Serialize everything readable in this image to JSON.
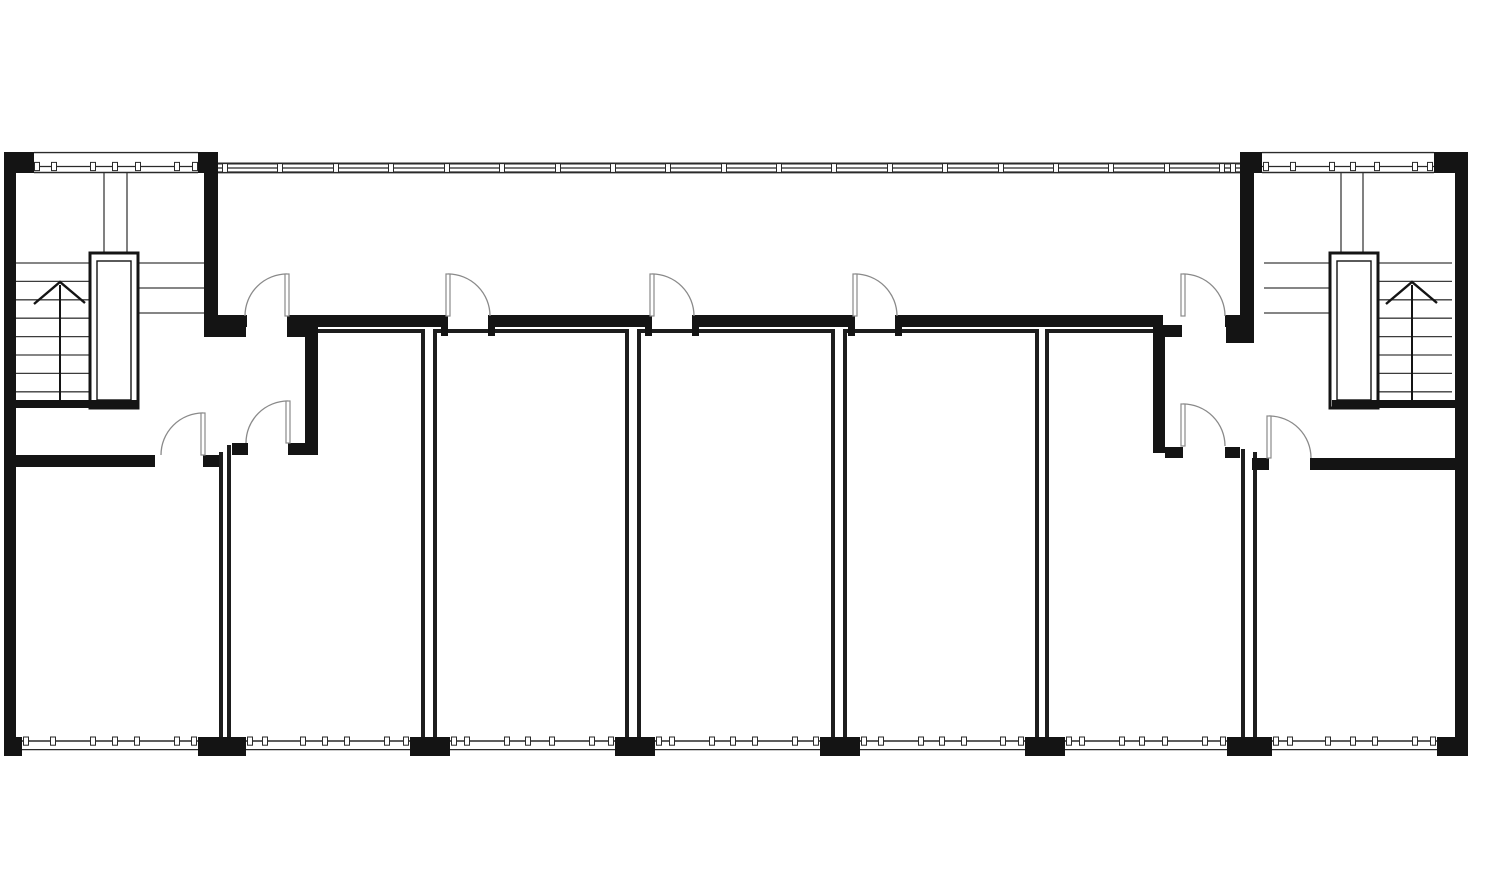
{
  "meta": {
    "kind": "architectural-floor-plan",
    "canvas": {
      "width": 1500,
      "height": 884
    }
  },
  "colors": {
    "background": "#ffffff",
    "wall": "#141414",
    "thin_wall": "#1d1d1d",
    "stair_line": "#3c3c3c",
    "door": "#8a8a8a",
    "band_line": "#2a2a2a",
    "tick_fill": "#ffffff"
  },
  "plan": {
    "solid_walls": [
      {
        "name": "exterior-wall-left",
        "r": [
          4,
          152,
          12,
          603
        ]
      },
      {
        "name": "exterior-wall-right",
        "r": [
          1455,
          152,
          13,
          603
        ]
      },
      {
        "name": "top-wall-left-block-west",
        "r": [
          4,
          152,
          30,
          21
        ]
      },
      {
        "name": "top-wall-left-block-east",
        "r": [
          198,
          152,
          20,
          21
        ]
      },
      {
        "name": "top-wall-right-block-west",
        "r": [
          1240,
          152,
          22,
          21
        ]
      },
      {
        "name": "top-wall-right-block-east",
        "r": [
          1434,
          152,
          34,
          21
        ]
      },
      {
        "name": "stair-separation-wall-left",
        "r": [
          204,
          152,
          14,
          185
        ]
      },
      {
        "name": "stair-separation-wall-right",
        "r": [
          1240,
          152,
          14,
          191
        ]
      },
      {
        "name": "corridor-wall-segment",
        "r": [
          218,
          315,
          29,
          12
        ]
      },
      {
        "name": "corridor-wall-segment",
        "r": [
          287,
          315,
          161,
          12
        ]
      },
      {
        "name": "corridor-wall-segment",
        "r": [
          488,
          315,
          164,
          12
        ]
      },
      {
        "name": "corridor-wall-segment",
        "r": [
          692,
          315,
          163,
          12
        ]
      },
      {
        "name": "corridor-wall-segment",
        "r": [
          895,
          315,
          268,
          12
        ]
      },
      {
        "name": "corridor-wall-segment",
        "r": [
          1225,
          315,
          15,
          12
        ]
      },
      {
        "name": "corridor-wall-foot-left",
        "r": [
          218,
          327,
          28,
          10
        ]
      },
      {
        "name": "corridor-wall-foot-right",
        "r": [
          1226,
          327,
          14,
          16
        ]
      },
      {
        "name": "door-jamb",
        "r": [
          441,
          327,
          7,
          9
        ]
      },
      {
        "name": "door-jamb",
        "r": [
          488,
          327,
          7,
          9
        ]
      },
      {
        "name": "door-jamb",
        "r": [
          645,
          327,
          7,
          9
        ]
      },
      {
        "name": "door-jamb",
        "r": [
          692,
          327,
          7,
          9
        ]
      },
      {
        "name": "door-jamb",
        "r": [
          848,
          327,
          7,
          9
        ]
      },
      {
        "name": "door-jamb",
        "r": [
          895,
          327,
          7,
          9
        ]
      },
      {
        "name": "vestibule-wall-left-head",
        "r": [
          287,
          325,
          31,
          12
        ]
      },
      {
        "name": "vestibule-wall-left",
        "r": [
          305,
          327,
          13,
          128
        ]
      },
      {
        "name": "vestibule-wall-right-head",
        "r": [
          1153,
          325,
          29,
          12
        ]
      },
      {
        "name": "vestibule-wall-right",
        "r": [
          1153,
          327,
          12,
          126
        ]
      },
      {
        "name": "room-a-entry-wall-west",
        "r": [
          232,
          443,
          16,
          12
        ]
      },
      {
        "name": "room-a-entry-wall-east",
        "r": [
          288,
          443,
          30,
          12
        ]
      },
      {
        "name": "room-e-entry-wall-west",
        "r": [
          1165,
          447,
          18,
          11
        ]
      },
      {
        "name": "room-e-entry-wall-east",
        "r": [
          1225,
          447,
          15,
          11
        ]
      },
      {
        "name": "corner-room-left-top-wall",
        "r": [
          4,
          455,
          151,
          12
        ]
      },
      {
        "name": "corner-room-left-door-jamb",
        "r": [
          203,
          455,
          16,
          12
        ]
      },
      {
        "name": "corner-room-right-door-jamb",
        "r": [
          1252,
          458,
          17,
          12
        ]
      },
      {
        "name": "corner-room-right-top-wall",
        "r": [
          1310,
          458,
          145,
          12
        ]
      },
      {
        "name": "stair-enclosure-wall-left",
        "r": [
          13,
          400,
          124,
          8
        ]
      },
      {
        "name": "stair-enclosure-wall-right",
        "r": [
          1332,
          400,
          123,
          8
        ]
      }
    ],
    "piers": [
      [
        4,
        737,
        18,
        19
      ],
      [
        198,
        737,
        48,
        19
      ],
      [
        410,
        737,
        40,
        19
      ],
      [
        615,
        737,
        40,
        19
      ],
      [
        820,
        737,
        40,
        19
      ],
      [
        1025,
        737,
        40,
        19
      ],
      [
        1227,
        737,
        45,
        19
      ],
      [
        1437,
        737,
        31,
        19
      ]
    ],
    "thin_walls": [
      {
        "name": "party-wall-line",
        "l": [
          221,
          452,
          221,
          739
        ]
      },
      {
        "name": "party-wall-line",
        "l": [
          229,
          445,
          229,
          739
        ]
      },
      {
        "name": "party-wall-line",
        "l": [
          423,
          331,
          423,
          739
        ]
      },
      {
        "name": "party-wall-line",
        "l": [
          435,
          331,
          435,
          739
        ]
      },
      {
        "name": "party-wall-line",
        "l": [
          627,
          331,
          627,
          739
        ]
      },
      {
        "name": "party-wall-line",
        "l": [
          639,
          331,
          639,
          739
        ]
      },
      {
        "name": "party-wall-line",
        "l": [
          833,
          331,
          833,
          739
        ]
      },
      {
        "name": "party-wall-line",
        "l": [
          845,
          331,
          845,
          739
        ]
      },
      {
        "name": "party-wall-line",
        "l": [
          1037,
          331,
          1037,
          739
        ]
      },
      {
        "name": "party-wall-line",
        "l": [
          1047,
          331,
          1047,
          739
        ]
      },
      {
        "name": "party-wall-line",
        "l": [
          1243,
          449,
          1243,
          739
        ]
      },
      {
        "name": "party-wall-line",
        "l": [
          1255,
          452,
          1255,
          739
        ]
      },
      {
        "name": "room-top-wall-line",
        "l": [
          316,
          331,
          425,
          331
        ]
      },
      {
        "name": "room-top-wall-line",
        "l": [
          433,
          331,
          629,
          331
        ]
      },
      {
        "name": "room-top-wall-line",
        "l": [
          637,
          331,
          835,
          331
        ]
      },
      {
        "name": "room-top-wall-line",
        "l": [
          843,
          331,
          1039,
          331
        ]
      },
      {
        "name": "room-top-wall-line",
        "l": [
          1045,
          331,
          1155,
          331
        ]
      }
    ],
    "stair_lines": [
      {
        "name": "stair-tread-line",
        "l": [
          16,
          263,
          90,
          263
        ]
      },
      {
        "name": "stair-tread-line",
        "l": [
          16,
          281.4,
          90,
          281.4
        ]
      },
      {
        "name": "stair-tread-line",
        "l": [
          16,
          299.8,
          90,
          299.8
        ]
      },
      {
        "name": "stair-tread-line",
        "l": [
          16,
          318.2,
          90,
          318.2
        ]
      },
      {
        "name": "stair-tread-line",
        "l": [
          16,
          336.6,
          90,
          336.6
        ]
      },
      {
        "name": "stair-tread-line",
        "l": [
          16,
          355,
          90,
          355
        ]
      },
      {
        "name": "stair-tread-line",
        "l": [
          16,
          373.4,
          90,
          373.4
        ]
      },
      {
        "name": "stair-tread-line",
        "l": [
          16,
          391.8,
          90,
          391.8
        ]
      },
      {
        "name": "stair-landing-line",
        "l": [
          138,
          263,
          204,
          263
        ]
      },
      {
        "name": "stair-landing-line",
        "l": [
          138,
          288,
          204,
          288
        ]
      },
      {
        "name": "stair-landing-line",
        "l": [
          138,
          313,
          204,
          313
        ]
      },
      {
        "name": "elevator-shaft-line",
        "l": [
          104,
          173,
          104,
          253
        ]
      },
      {
        "name": "elevator-shaft-line",
        "l": [
          127,
          173,
          127,
          253
        ]
      },
      {
        "name": "stair-tread-line",
        "l": [
          1379,
          263,
          1452,
          263
        ]
      },
      {
        "name": "stair-tread-line",
        "l": [
          1379,
          281.4,
          1452,
          281.4
        ]
      },
      {
        "name": "stair-tread-line",
        "l": [
          1379,
          299.8,
          1452,
          299.8
        ]
      },
      {
        "name": "stair-tread-line",
        "l": [
          1379,
          318.2,
          1452,
          318.2
        ]
      },
      {
        "name": "stair-tread-line",
        "l": [
          1379,
          336.6,
          1452,
          336.6
        ]
      },
      {
        "name": "stair-tread-line",
        "l": [
          1379,
          355,
          1452,
          355
        ]
      },
      {
        "name": "stair-tread-line",
        "l": [
          1379,
          373.4,
          1452,
          373.4
        ]
      },
      {
        "name": "stair-tread-line",
        "l": [
          1379,
          391.8,
          1452,
          391.8
        ]
      },
      {
        "name": "stair-landing-line",
        "l": [
          1264,
          263,
          1332,
          263
        ]
      },
      {
        "name": "stair-landing-line",
        "l": [
          1264,
          288,
          1332,
          288
        ]
      },
      {
        "name": "stair-landing-line",
        "l": [
          1264,
          313,
          1332,
          313
        ]
      },
      {
        "name": "elevator-shaft-line",
        "l": [
          1341,
          173,
          1341,
          253
        ]
      },
      {
        "name": "elevator-shaft-line",
        "l": [
          1363,
          173,
          1363,
          253
        ]
      }
    ],
    "elevators": [
      {
        "name": "elevator-left",
        "outer": [
          90,
          253,
          48,
          155
        ],
        "inner": [
          97,
          261,
          34,
          139
        ]
      },
      {
        "name": "elevator-right",
        "outer": [
          1330,
          253,
          48,
          155
        ],
        "inner": [
          1337,
          261,
          34,
          139
        ]
      }
    ],
    "arrows": [
      {
        "name": "stair-up-arrow-left",
        "stem": [
          60,
          402,
          285
        ],
        "chevron": [
          [
            34,
            304
          ],
          [
            60,
            282
          ],
          [
            85,
            303
          ]
        ]
      },
      {
        "name": "stair-up-arrow-right",
        "stem": [
          1412,
          402,
          285
        ],
        "chevron": [
          [
            1386,
            304
          ],
          [
            1412,
            282
          ],
          [
            1437,
            303
          ]
        ]
      }
    ],
    "doors": [
      {
        "name": "corridor-door-left-lobby",
        "hinge": [
          287,
          316
        ],
        "r": 42,
        "dir": -1
      },
      {
        "name": "room-b-corridor-door",
        "hinge": [
          448,
          316
        ],
        "r": 42,
        "dir": 1
      },
      {
        "name": "room-c-corridor-door",
        "hinge": [
          652,
          316
        ],
        "r": 42,
        "dir": 1
      },
      {
        "name": "room-d-corridor-door",
        "hinge": [
          855,
          316
        ],
        "r": 42,
        "dir": 1
      },
      {
        "name": "corridor-door-right-lobby",
        "hinge": [
          1183,
          316
        ],
        "r": 42,
        "dir": 1
      },
      {
        "name": "room-a-entry-door",
        "hinge": [
          288,
          443
        ],
        "r": 42,
        "dir": -1
      },
      {
        "name": "room-e-entry-door",
        "hinge": [
          1183,
          446
        ],
        "r": 42,
        "dir": 1
      },
      {
        "name": "corner-room-left-door",
        "hinge": [
          203,
          455
        ],
        "r": 42,
        "dir": -1
      },
      {
        "name": "corner-room-right-door",
        "hinge": [
          1269,
          458
        ],
        "r": 42,
        "dir": 1
      }
    ],
    "window_bands": [
      {
        "name": "curtain-window-band-top",
        "kind": "main",
        "x1": 218,
        "x2": 1240,
        "lines": [
          [
            163.5,
            2
          ],
          [
            168,
            1.2
          ],
          [
            172.4,
            2
          ]
        ],
        "tick_y": 163.6,
        "tick_h": 8.8,
        "ticks": [
          225,
          280,
          336,
          391,
          447,
          502,
          558,
          613,
          668,
          724,
          779,
          834,
          890,
          945,
          1001,
          1056,
          1111,
          1167,
          1222,
          1233
        ]
      },
      {
        "name": "window-band-top-left-block",
        "kind": "block",
        "x1": 34,
        "x2": 198,
        "lines": [
          [
            152.6,
            1.4
          ],
          [
            166.5,
            1.2
          ],
          [
            172.5,
            1.4
          ]
        ],
        "tick_y": 162.4,
        "tick_h": 8.2,
        "ticks": [
          37,
          54,
          93,
          115,
          138,
          177,
          195
        ]
      },
      {
        "name": "window-band-top-right-block",
        "kind": "block",
        "x1": 1262,
        "x2": 1434,
        "lines": [
          [
            152.6,
            1.4
          ],
          [
            166.5,
            1.2
          ],
          [
            172.5,
            1.4
          ]
        ],
        "tick_y": 162.4,
        "tick_h": 8.2,
        "ticks": [
          1266,
          1293,
          1332,
          1353,
          1377,
          1415,
          1430
        ]
      },
      {
        "name": "window-band-bottom",
        "kind": "bottom",
        "x1": 22,
        "x2": 198,
        "lines": [
          [
            741,
            1.4
          ],
          [
            749.6,
            1.2
          ]
        ],
        "tick_y": 737,
        "tick_h": 8.2,
        "ticks": [
          26,
          53,
          93,
          115,
          137,
          177,
          194
        ]
      },
      {
        "name": "window-band-bottom",
        "kind": "bottom",
        "x1": 246,
        "x2": 410,
        "lines": [
          [
            741,
            1.4
          ],
          [
            749.6,
            1.2
          ]
        ],
        "tick_y": 737,
        "tick_h": 8.2,
        "ticks": [
          250,
          265,
          303,
          325,
          347,
          387,
          406
        ]
      },
      {
        "name": "window-band-bottom",
        "kind": "bottom",
        "x1": 450,
        "x2": 615,
        "lines": [
          [
            741,
            1.4
          ],
          [
            749.6,
            1.2
          ]
        ],
        "tick_y": 737,
        "tick_h": 8.2,
        "ticks": [
          454,
          467,
          507,
          528,
          552,
          592,
          611
        ]
      },
      {
        "name": "window-band-bottom",
        "kind": "bottom",
        "x1": 655,
        "x2": 820,
        "lines": [
          [
            741,
            1.4
          ],
          [
            749.6,
            1.2
          ]
        ],
        "tick_y": 737,
        "tick_h": 8.2,
        "ticks": [
          659,
          672,
          712,
          733,
          755,
          795,
          816
        ]
      },
      {
        "name": "window-band-bottom",
        "kind": "bottom",
        "x1": 860,
        "x2": 1025,
        "lines": [
          [
            741,
            1.4
          ],
          [
            749.6,
            1.2
          ]
        ],
        "tick_y": 737,
        "tick_h": 8.2,
        "ticks": [
          864,
          881,
          921,
          942,
          964,
          1003,
          1021
        ]
      },
      {
        "name": "window-band-bottom",
        "kind": "bottom",
        "x1": 1065,
        "x2": 1227,
        "lines": [
          [
            741,
            1.4
          ],
          [
            749.6,
            1.2
          ]
        ],
        "tick_y": 737,
        "tick_h": 8.2,
        "ticks": [
          1069,
          1082,
          1122,
          1142,
          1165,
          1205,
          1223
        ]
      },
      {
        "name": "window-band-bottom",
        "kind": "bottom",
        "x1": 1272,
        "x2": 1437,
        "lines": [
          [
            741,
            1.4
          ],
          [
            749.6,
            1.2
          ]
        ],
        "tick_y": 737,
        "tick_h": 8.2,
        "ticks": [
          1276,
          1290,
          1328,
          1353,
          1375,
          1415,
          1433
        ]
      }
    ]
  }
}
